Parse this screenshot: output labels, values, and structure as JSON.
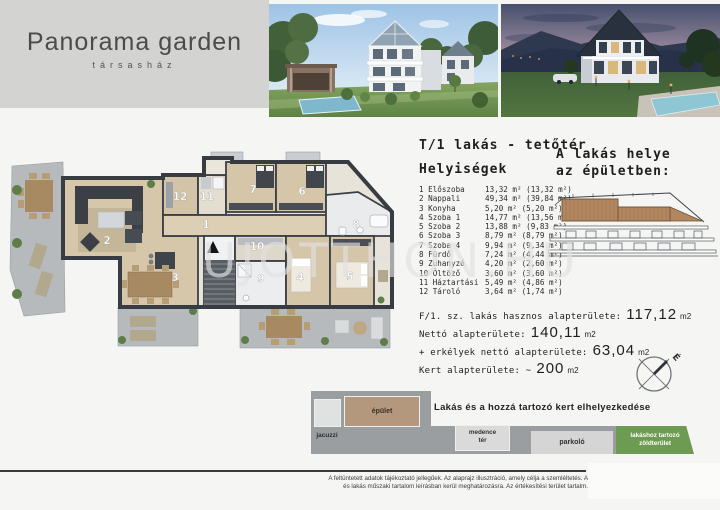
{
  "header": {
    "title": "Panorama garden",
    "subtitle": "társasház"
  },
  "unit": {
    "title": "T/1 lakás - tetőtér",
    "rooms_heading": "Helyiségek",
    "location_heading_line1": "A lakás helye",
    "location_heading_line2": "az épületben:",
    "rooms": [
      {
        "label": "1 Előszoba",
        "area": "13,32 m² (13,32 m²)"
      },
      {
        "label": "2 Nappali",
        "area": "49,34 m² (39,84 m²)"
      },
      {
        "label": "3 Konyha",
        "area": "5,20 m² (5,20 m²)"
      },
      {
        "label": "4 Szoba 1",
        "area": "14,77 m² (13,56 m²)"
      },
      {
        "label": "5 Szoba 2",
        "area": "13,88 m² (9,83 m²)"
      },
      {
        "label": "6 Szoba 3",
        "area": "8,79 m² (8,79 m²)"
      },
      {
        "label": "7 Szoba 4",
        "area": "9,94 m² (9,34 m²)"
      },
      {
        "label": "8 Fürdő",
        "area": "7,24 m² (4,44 m²)"
      },
      {
        "label": "9 Zuhanyzó",
        "area": "4,20 m² (2,60 m²)"
      },
      {
        "label": "10 Öltöző",
        "area": "3,60 m² (3,60 m²)"
      },
      {
        "label": "11 Háztartási",
        "area": "5,49 m² (4,86 m²)"
      },
      {
        "label": "12 Tároló",
        "area": "3,64 m² (1,74 m²)"
      }
    ],
    "totals": [
      {
        "label": "F/1. sz. lakás hasznos alapterülete:",
        "value": "117,12",
        "unit": "m2"
      },
      {
        "label": "Nettó alapterülete:",
        "value": "140,11",
        "unit": "m2"
      },
      {
        "label": "+ erkélyek nettó alapterülete:",
        "value": "63,04",
        "unit": "m2"
      },
      {
        "label": "Kert alapterülete: ~",
        "value": "200",
        "unit": "m2"
      }
    ],
    "compass_label": "É"
  },
  "floorplan": {
    "watermark": "UJOTTHON.HU",
    "room_labels": [
      "1",
      "2",
      "3",
      "4",
      "5",
      "6",
      "7",
      "8",
      "9",
      "10",
      "11",
      "12"
    ]
  },
  "siteplan": {
    "title": "Lakás és a hozzá tartozó kert elhelyezkedése",
    "jacuzzi": "jacuzzi",
    "building": "épület",
    "pool_line1": "medence",
    "pool_line2": "tér",
    "parking": "parkoló",
    "green_line1": "lakáshoz tartozó",
    "green_line2": "zöldterület"
  },
  "footer": {
    "line1": "A feltüntetett adatok tájékoztató jellegűek. Az alaprajz illusztráció, amely célja a szemléltetés. A",
    "line2": "és lakás műszaki tartalom leírásban kerül meghatározásra. Az értékesítési terület tartalm."
  }
}
